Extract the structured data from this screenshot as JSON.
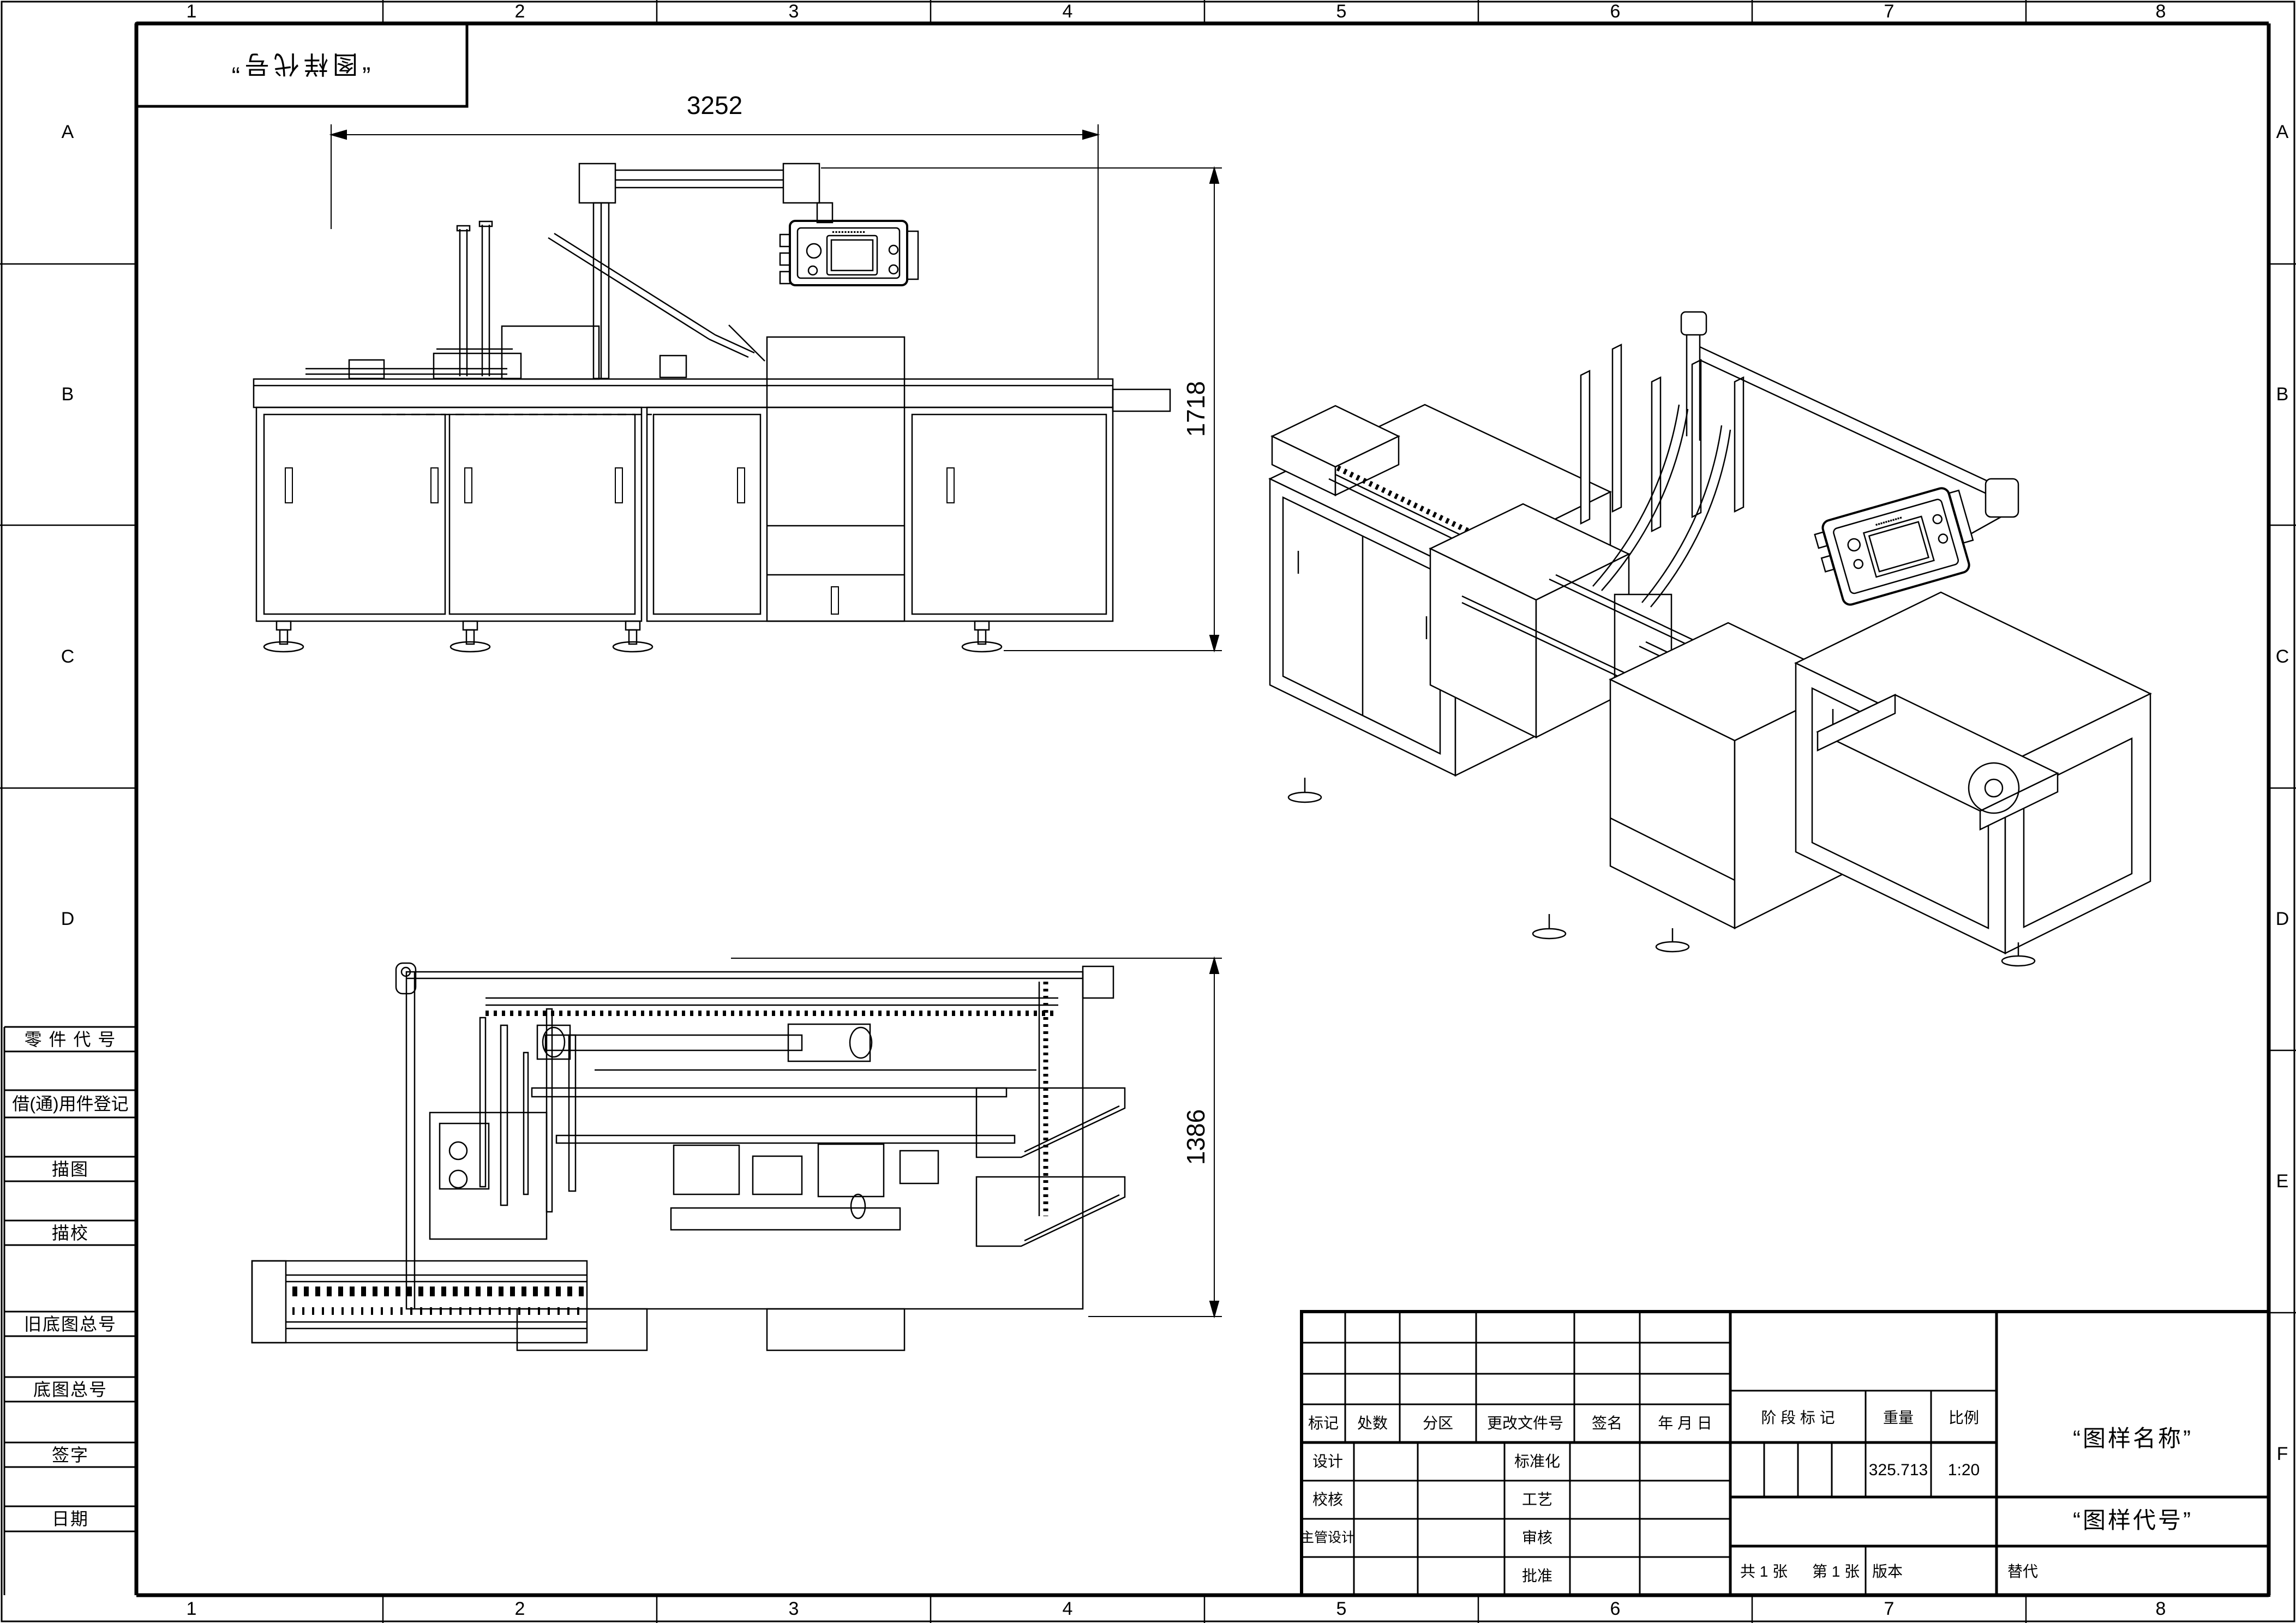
{
  "frame": {
    "columns": [
      "1",
      "2",
      "3",
      "4",
      "5",
      "6",
      "7",
      "8"
    ],
    "rows_right": [
      "A",
      "B",
      "C",
      "D",
      "E",
      "F"
    ],
    "rows_left": [
      "A",
      "B",
      "C",
      "D"
    ]
  },
  "stamp": {
    "code": "“图样代号”"
  },
  "margin_table": {
    "rows": [
      "零 件 代 号",
      "借(通)用件登记",
      "描图",
      "描校",
      "旧底图总号",
      "底图总号",
      "签字",
      "日期"
    ]
  },
  "dims": {
    "front_width": "3252",
    "front_height": "1718",
    "top_depth": "1386"
  },
  "hmi": {
    "brand": "▪▪▪▪▪▪▪▪▪▪▪"
  },
  "title_block": {
    "change_cols": [
      "标记",
      "处数",
      "分区",
      "更改文件号",
      "签名",
      "年 月 日"
    ],
    "rows": [
      [
        "设计",
        "标准化"
      ],
      [
        "校核",
        "工艺"
      ],
      [
        "主管设计",
        "审核"
      ],
      [
        "",
        "批准"
      ]
    ],
    "stage_label": "阶 段 标 记",
    "weight_label": "重量",
    "scale_label": "比例",
    "weight": "325.713",
    "scale": "1:20",
    "name": "“图样名称”",
    "code": "“图样代号”",
    "sheet_count": "共 1 张",
    "sheet_no": "第 1 张",
    "version": "版本",
    "replace": "替代"
  }
}
